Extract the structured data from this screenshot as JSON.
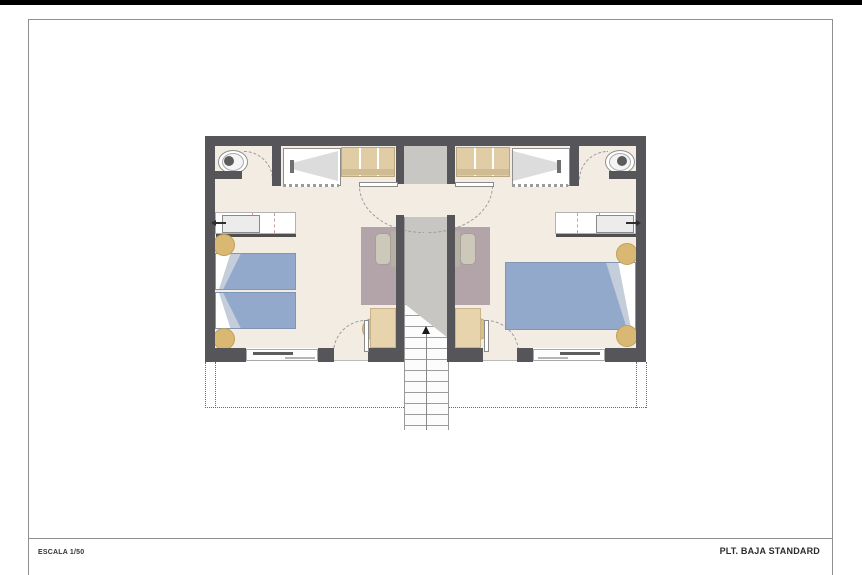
{
  "sheet": {
    "scale_label": "ESCALA 1/50",
    "plan_title": "PLT. BAJA STANDARD"
  },
  "drawing": {
    "type": "architectural-floor-plan",
    "description_semantic": "two mirrored guest rooms with central entry vestibule and staircase going down",
    "left_room_furniture": [
      "toilet",
      "shower",
      "wardrobe",
      "vanity-counter",
      "twin-bed",
      "twin-bed",
      "nightstand",
      "nightstand",
      "armchair",
      "rug",
      "desk",
      "desk-chair",
      "sliding-window",
      "door"
    ],
    "right_room_furniture": [
      "toilet",
      "shower",
      "wardrobe",
      "vanity-counter",
      "double-bed",
      "nightstand",
      "nightstand",
      "armchair",
      "rug",
      "desk",
      "desk-chair",
      "sliding-window",
      "door"
    ],
    "core_elements": [
      "entry-vestibule",
      "entry-double-door",
      "staircase",
      "stair-direction-arrow",
      "terrace-dashed-outline"
    ],
    "palette": {
      "wall": "#56555a",
      "floor": "#f2ece3",
      "core_gray": "#c7c6c3",
      "bed_blue": "#93a9cb",
      "pillow_gray": "#c4cdda",
      "wood_tan": "#e0cda5",
      "nightstand_tan": "#d9b873",
      "rug_mauve": "#b3a4aa",
      "armchair_beige": "#ccc8ba",
      "frame_line": "#8f8f8f",
      "text": "#2c2c2c"
    }
  }
}
